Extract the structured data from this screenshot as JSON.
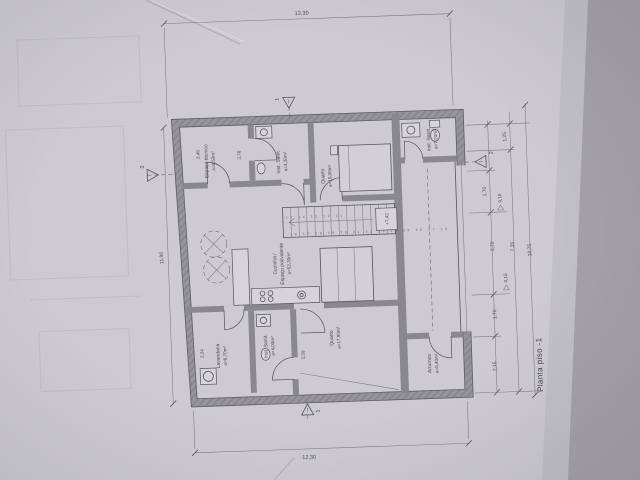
{
  "drawing_title": "Planta piso -1",
  "plan": {
    "rooms": {
      "espaco_tecnico": {
        "label": "Espaço técnico",
        "area": "a=8,50m²"
      },
      "inst_sanit_top": {
        "label": "Inst. Sanit.",
        "area": "a=4,30m²"
      },
      "quarto_top": {
        "label": "Quarto",
        "area": "a=15,00m²"
      },
      "inst_sanit_suite": {
        "label": "Inst. Sanit.",
        "area": "a=7,20m²"
      },
      "cozinha": {
        "label": "Cozinha /",
        "label2": "Espaço polivalente",
        "area": "a=52,30m²"
      },
      "lavandaria": {
        "label": "Lavandaria",
        "area": "a=6,70m²"
      },
      "inst_sanit_baixo": {
        "label": "Inst. Sanit.",
        "area": "a=4,00m²"
      },
      "quarto_baixo": {
        "label": "Quarto",
        "area": "a=17,90m²"
      },
      "arrumos": {
        "label": "Arrumos",
        "area": "a=5,40m²"
      }
    },
    "stairs": {
      "level": "+7,42",
      "upper_steps": "15 14 13 12 11",
      "lower_steps": "16 17 18 19 20 21 22 23 24 25 26 27 28"
    },
    "dims": {
      "top": "12,30",
      "bottom": "12,30",
      "left": "11,90",
      "r1": "1,25",
      "r2": "1,70",
      "r3": "1,70",
      "r4": "2,15",
      "t1": "3,70",
      "t2": "7,35",
      "t3": "10,75",
      "lev1": "0,15",
      "lev2": "0,15",
      "i1": "2,45",
      "i2": "2,78",
      "i3": "2,34",
      "i4": "2,39"
    },
    "sections": {
      "s1": "1",
      "s2": "2"
    }
  }
}
